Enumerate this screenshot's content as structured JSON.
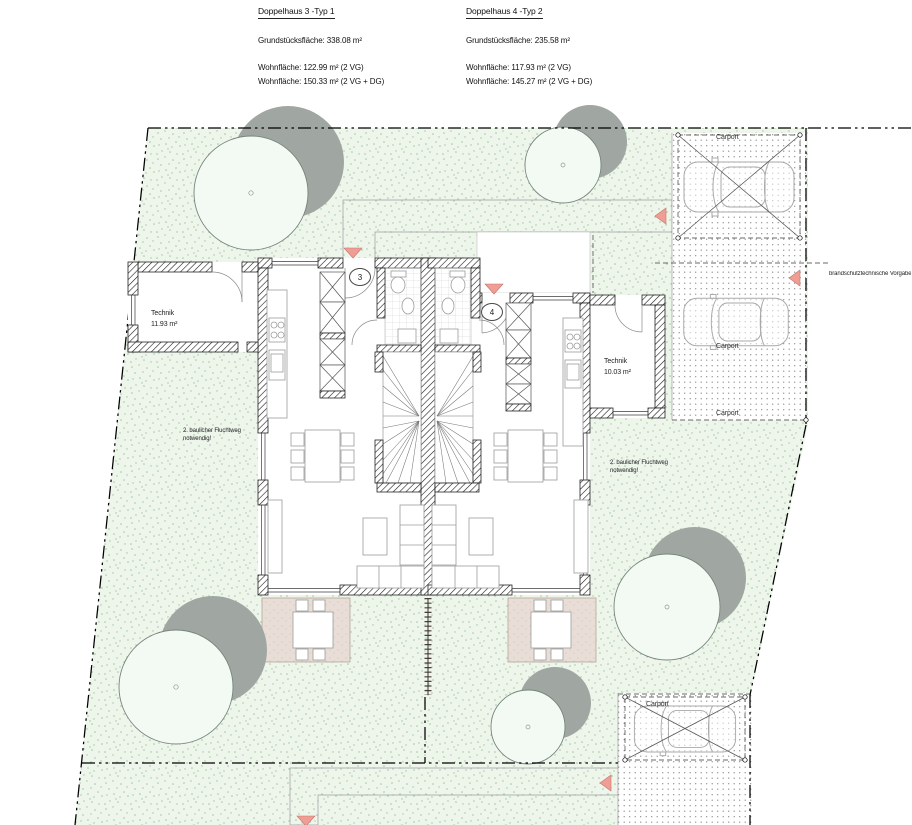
{
  "header": {
    "houses": [
      {
        "title": "Doppelhaus 3 -Typ 1",
        "plot_area": "Grundstücksfläche: 338.08 m²",
        "living_area_vg": "Wohnfläche: 122.99 m² (2 VG)",
        "living_area_dg": "Wohnfläche: 150.33 m² (2 VG + DG)"
      },
      {
        "title": "Doppelhaus 4 -Typ 2",
        "plot_area": "Grundstücksfläche: 235.58 m²",
        "living_area_vg": "Wohnfläche: 117.93 m² (2 VG)",
        "living_area_dg": "Wohnfläche: 145.27 m² (2 VG + DG)"
      }
    ]
  },
  "rooms": {
    "technik_left": {
      "name": "Technik",
      "area": "11.93 m²"
    },
    "technik_right": {
      "name": "Technik",
      "area": "10.03 m²"
    }
  },
  "labels": {
    "carport": "Carport",
    "unit_left": "3",
    "unit_right": "4"
  },
  "notes": {
    "escape_line1": "2. baulicher Fluchtweg",
    "escape_line2": "notwendig!",
    "fire_protection": "brandschutztechnische Vorgaben Sta"
  },
  "colors": {
    "lawn": "#edf6ec",
    "tree_shadow": "#a0a7a2",
    "terrace": "#e9ded7",
    "marker": "#f19d94"
  }
}
